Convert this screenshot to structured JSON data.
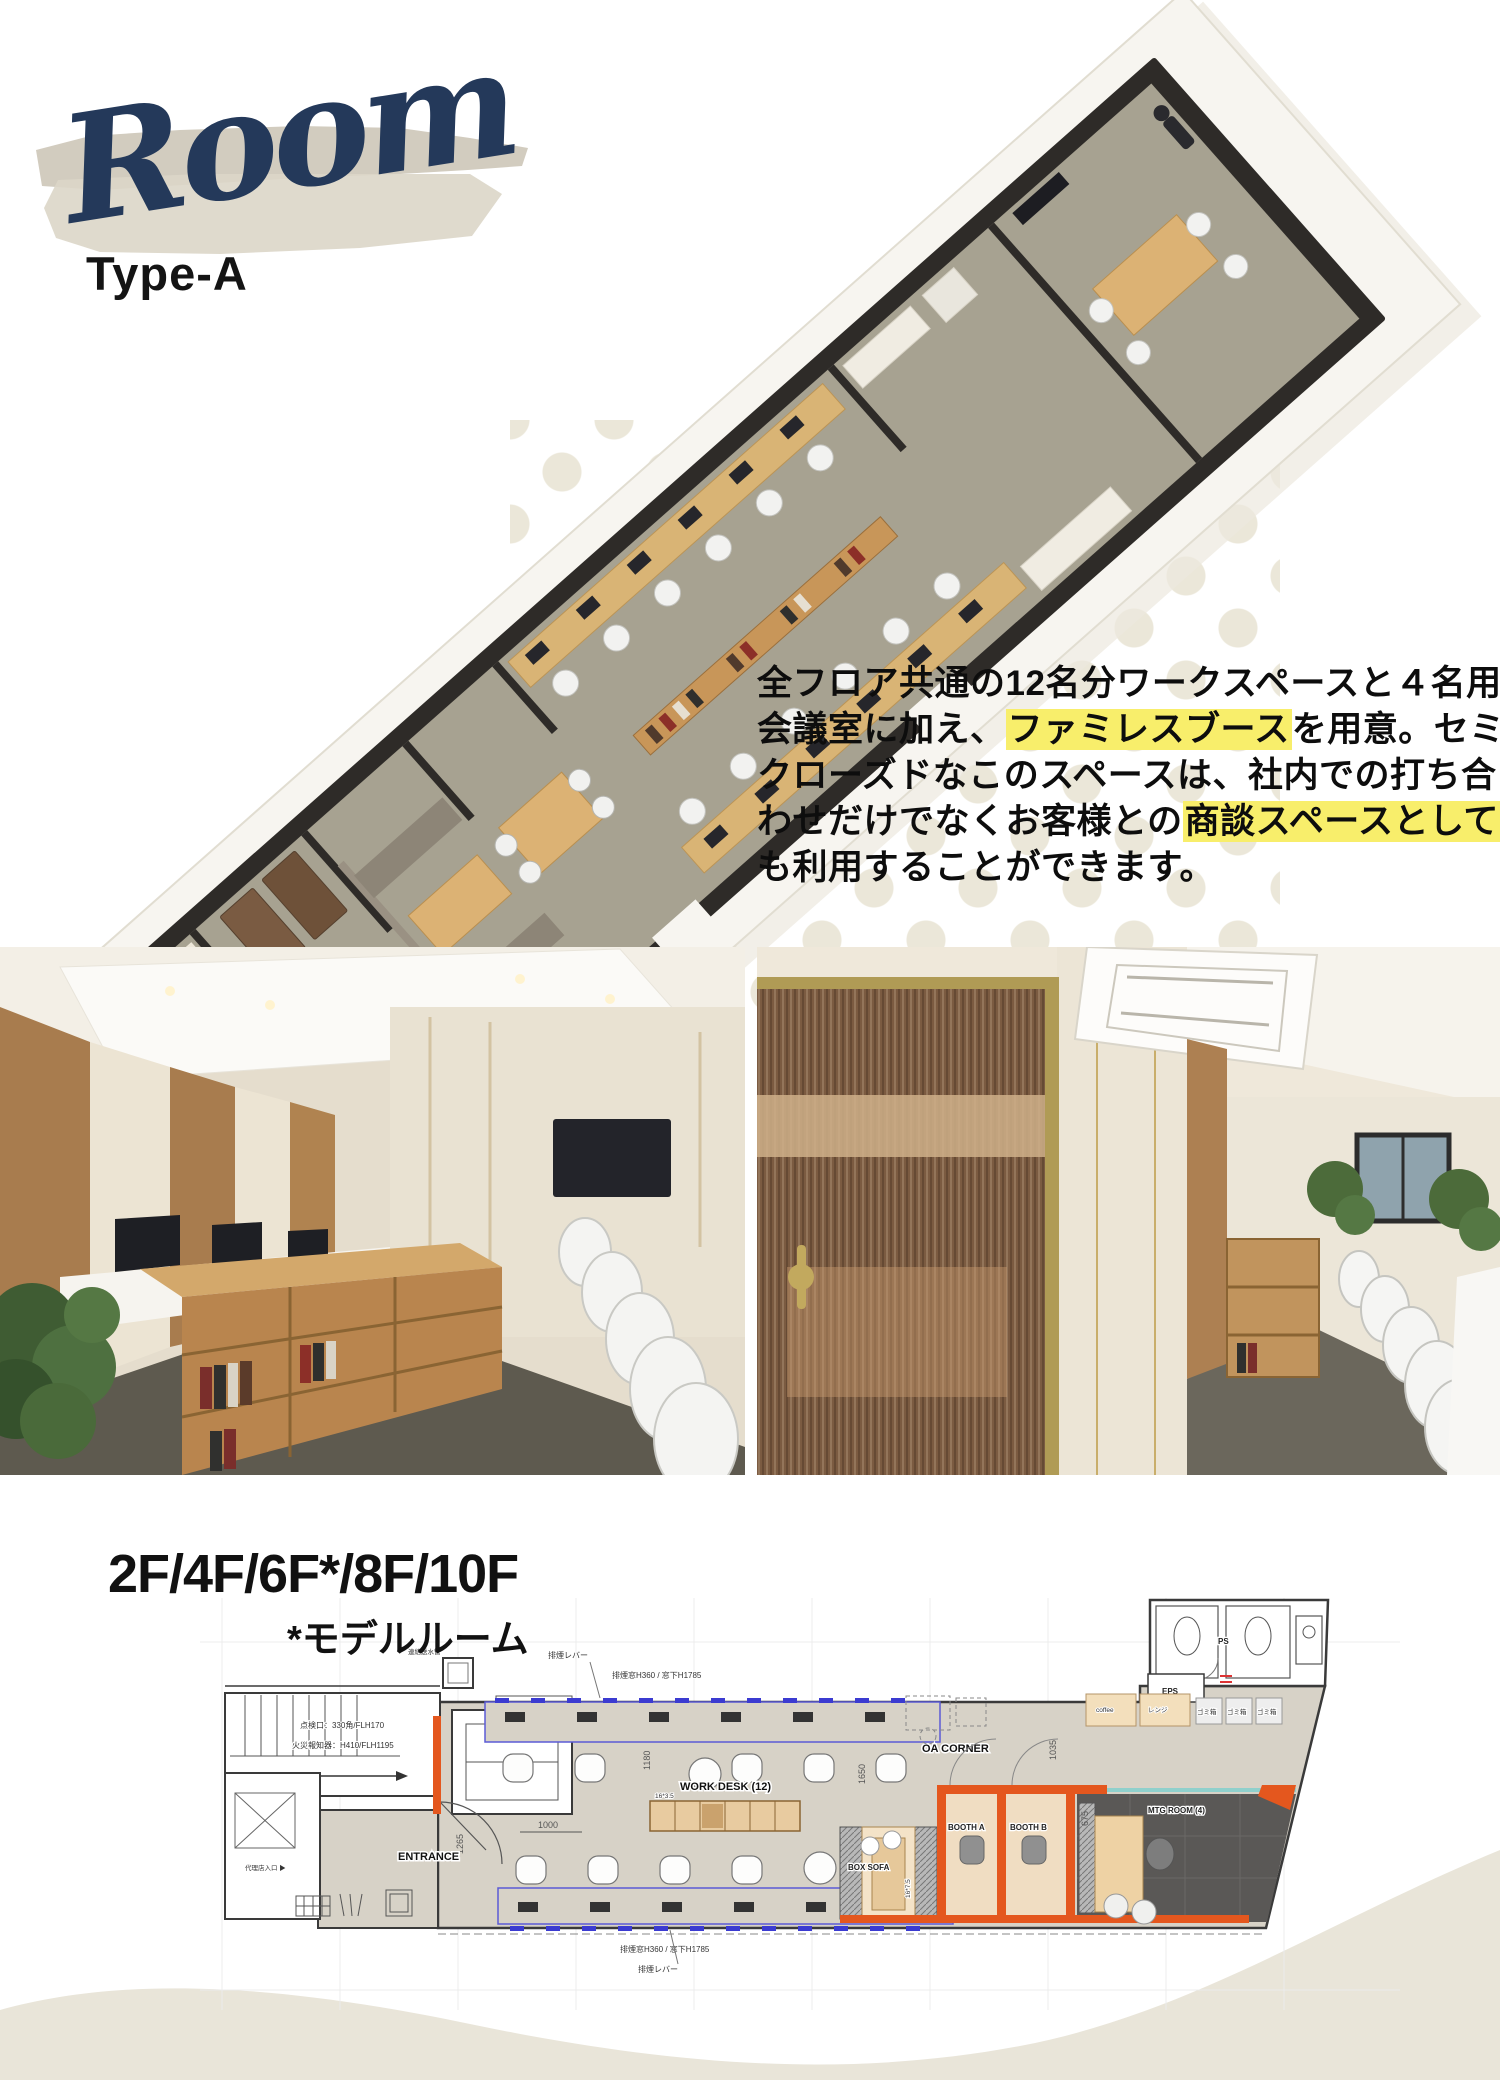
{
  "header": {
    "script_title": "Room",
    "subtitle": "Type-A",
    "colors": {
      "script": "#24395a",
      "brush": "#d2ccbf",
      "brush_light": "#dcd6c8"
    }
  },
  "intro": {
    "highlight_color": "#f8ee6b",
    "lines": [
      [
        {
          "t": "全フロア共通の12名分ワークスペースと４名用",
          "h": false
        }
      ],
      [
        {
          "t": "会議室に加え、",
          "h": false
        },
        {
          "t": "ファミレスブース",
          "h": true
        },
        {
          "t": "を用意。セミ",
          "h": false
        }
      ],
      [
        {
          "t": "クローズドなこのスペースは、社内での打ち合",
          "h": false
        }
      ],
      [
        {
          "t": "わせだけでなくお客様との",
          "h": false
        },
        {
          "t": "商談スペースとして",
          "h": true
        }
      ],
      [
        {
          "t": "も利用することができます。",
          "h": false
        }
      ]
    ]
  },
  "floors": {
    "heading": "2F/4F/6F*/8F/10F",
    "note": "*モデルルーム"
  },
  "floorplan": {
    "labels": {
      "entrance": "ENTRANCE",
      "elv": "ELV",
      "work_desk": "WORK DESK (12)",
      "oa_corner": "OA CORNER",
      "box_sofa": "BOX SOFA",
      "booth_a": "BOOTH A",
      "booth_b": "BOOTH B",
      "mtg_room": "MTG ROOM (4)",
      "eps": "EPS",
      "ps": "PS",
      "coffee": "coffee",
      "range": "レンジ",
      "trash1": "ゴミ箱",
      "trash2": "ゴミ箱",
      "trash3": "ゴミ箱",
      "staff_entrance": "代理店入口 ▶",
      "inspection_hatch": "点検口：330角/FLH170",
      "fire_detector": "火災報知器：H410/FLH1195",
      "water_pipe": "連結送水管",
      "smoke_lever_top": "排煙レバー",
      "smoke_window_top": "排煙窓H360 / 窓下H1785",
      "smoke_window_bottom": "排煙窓H360 / 窓下H1785",
      "smoke_lever_bottom": "排煙レバー",
      "shelf_size": "16*3.5",
      "sofa_size": "16*7.5"
    },
    "dimensions": {
      "d1000": "1000",
      "d1265": "1265",
      "d1180": "1180",
      "d1650": "1650",
      "d1035": "1035",
      "d675": "675"
    },
    "colors": {
      "floor": "#d7d2c7",
      "booth_wall": "#e4571e",
      "booth_floor": "#f0ddc2",
      "mtg_floor": "#5a5856",
      "accent_blue": "#3b3bd1",
      "wood": "#e8cba0"
    }
  },
  "footer": {
    "wave_color": "#e9e5d9"
  },
  "decor": {
    "dot_color": "#ebe7d9"
  }
}
